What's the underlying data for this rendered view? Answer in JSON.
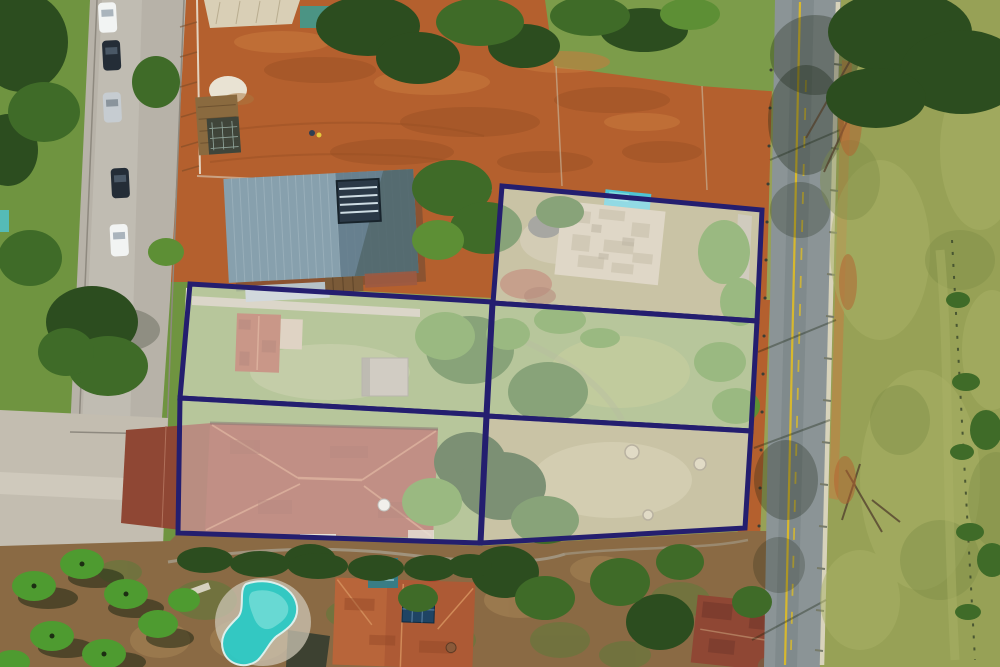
{
  "canvas": {
    "width": 1000,
    "height": 667
  },
  "theme": {
    "navy": "#241e6f",
    "wash": "#ffffff",
    "wash-opacity": "0.38",
    "lot-stroke": "5",
    "dirt": "#b4602e",
    "dirt-dark": "#9a4f24",
    "dirt-light": "#c97a3e",
    "park-grass": "#6f9440",
    "field": "#97a156",
    "field-light": "#aab266",
    "field-dark": "#7c8c47",
    "grass-top": "#7c9c4a",
    "tree-dark": "#2c4d1f",
    "tree-mid": "#3f6b28",
    "tree-light": "#5d8f35",
    "palm": "#4e9b30",
    "shadow": "#16220f",
    "road": "#8b9496",
    "road-dark": "#6e797c",
    "yellow": "#d7b82e",
    "curb": "#d8d3bb",
    "cobble": "#b7b2a8",
    "cobble-light": "#c9c4ba",
    "plaza": "#c3bdb0",
    "metal-roof": "#87a0ad",
    "metal-roof-shade": "#5f7887",
    "old-roof": "#cbbfa5",
    "old-roof-worn": "#b2a486",
    "red-roof-small": "#a8573f",
    "red-roof-big": "#9c4b3b",
    "red-roof-hip": "#c07a5c",
    "orange-roof": "#ad5a35",
    "dark-red-roof": "#8f4734",
    "pool": "#2fc9c4",
    "pool-light": "#8ce4de",
    "teal": "#4fc4d4",
    "sand": "#e9e3d3",
    "car-white": "#f2f4f3",
    "car-dark": "#242d37",
    "car-silver": "#c6ccd1",
    "wall-white": "#e9e5da",
    "garden": "#8a6a44",
    "shed": "#b5ad9e",
    "solar": "#1f4464",
    "lot-grass-b": "#8ba35e",
    "lot-grass-c": "#a89f6e"
  },
  "overlay": {
    "outlined_lot_count": 5,
    "columns": 2,
    "left_column_lots": 2,
    "right_column_lots": 3,
    "lots": [
      {
        "id": "middle-left",
        "points": "190,284 492,302 486,415 180,398"
      },
      {
        "id": "bottom-left",
        "points": "180,398 486,415 480,543 178,533"
      },
      {
        "id": "top-right",
        "points": "502,186 762,210 757,321 493,303"
      },
      {
        "id": "middle-right",
        "points": "493,303 757,321 751,431 487,416"
      },
      {
        "id": "bottom-right",
        "points": "487,416 751,431 745,528 481,543"
      }
    ]
  },
  "scene": {
    "parked_cars": 5,
    "car_colors": [
      "white",
      "dark",
      "silver",
      "dark",
      "white"
    ],
    "features": [
      "cobblestone-street",
      "bare-earth-lot",
      "metal-roof-house",
      "old-building",
      "red-tile-house",
      "swimming-pool",
      "paved-road-with-yellow-line",
      "grass-field"
    ]
  }
}
